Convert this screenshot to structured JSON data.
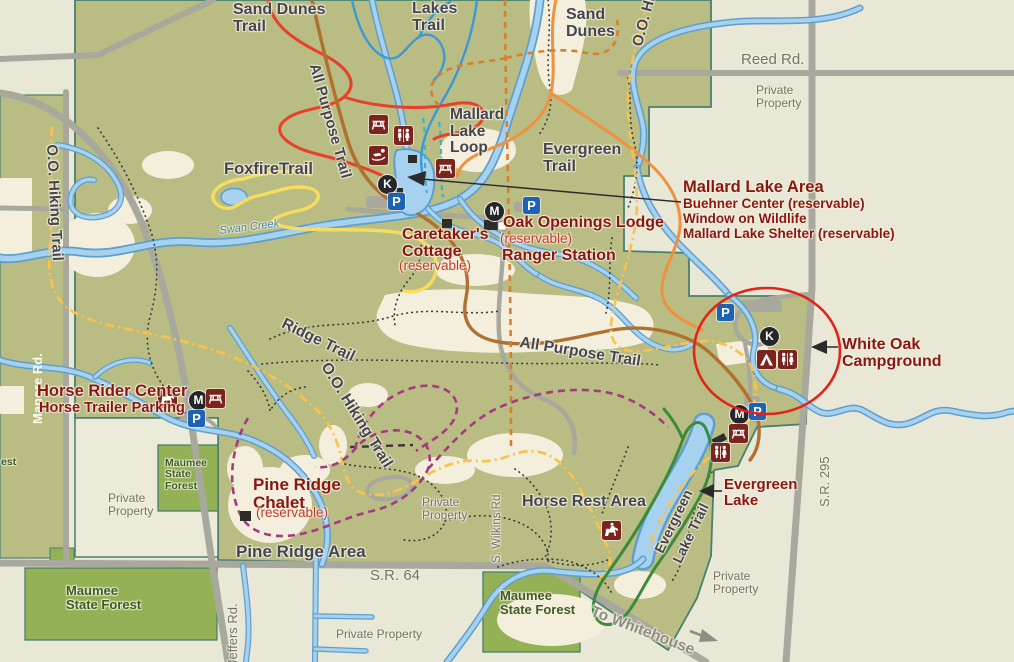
{
  "map_title": "Oak Openings park trail map",
  "colors": {
    "park_green": "#b9bc83",
    "forest_green": "#94b156",
    "background_cream": "#e9e7d6",
    "open_sand": "#f3efdc",
    "water_fill": "#a6d2ef",
    "water_edge": "#5f9fce",
    "road_gray": "#a9a89d",
    "boundary_teal": "#47806f",
    "label_dark": "#45454e",
    "label_red": "#8a170f",
    "reservable_red": "#c23b2a",
    "road_label_gray": "#73736b",
    "forest_label_green": "#3d5b23",
    "icon_maroon": "#7b231c",
    "parking_blue": "#1d62b5",
    "annotation_red": "#e2231a",
    "trail_red": "#e8402b",
    "trail_orange": "#f09140",
    "trail_brown": "#b0702f",
    "trail_yellow": "#f6dc60",
    "trail_yellow_dashdot": "#f9c24e",
    "trail_orange_dashed": "#d87f2f",
    "trail_purple": "#a43a80",
    "trail_green": "#3c8a3e",
    "trail_blue": "#3a9ad6",
    "trail_teal_dashed": "#35b8c4"
  },
  "trail_labels": {
    "sand_dunes_trail": "Sand Dunes\nTrail",
    "lakes_trail": "Lakes\nTrail",
    "sand_dunes": "Sand\nDunes",
    "oo_hiking_partial": "O.O. Hi",
    "all_purpose_north": "All Purpose Trail",
    "mallard_lake_loop": "Mallard\nLake\nLoop",
    "evergreen_trail": "Evergreen\nTrail",
    "foxfire_trail": "FoxfireTrail",
    "oo_hiking_west": "O.O. Hiking Trail",
    "ridge_trail": "Ridge Trail",
    "all_purpose_mid": "All Purpose Trail",
    "oo_hiking_mid": "O.O. Hiking Trail",
    "evergreen_lake_trail_line1": "Evergreen",
    "evergreen_lake_trail_line2": "Lake Trail"
  },
  "road_labels": {
    "reed_rd": "Reed Rd.",
    "manore_rd": "Manore Rd.",
    "sr_295": "S.R. 295",
    "sr_64": "S.R. 64",
    "jeffers_rd": "Jeffers Rd.",
    "s_wilkins_rd": "S. Wilkins Rd.",
    "to_whitehouse": "To Whitehouse"
  },
  "water_labels": {
    "swan_creek": "Swan Creek"
  },
  "poi": {
    "mallard_lake_area": {
      "title": "Mallard Lake Area",
      "line1": "Buehner Center (reservable)",
      "line2": "Window on Wildlife",
      "line3": "Mallard Lake Shelter (reservable)"
    },
    "caretakers_cottage": {
      "name": "Caretaker's\nCottage",
      "note": "(reservable)"
    },
    "oak_openings_lodge": {
      "name": "Oak Openings Lodge",
      "note": "(reservable)"
    },
    "ranger_station": "Ranger Station",
    "white_oak_campground": "White Oak Campground",
    "horse_rider_center": "Horse Rider Center",
    "horse_trailer_parking": "Horse Trailer Parking",
    "pine_ridge_chalet": {
      "name": "Pine Ridge\nChalet",
      "note": "(reservable)"
    },
    "pine_ridge_area": "Pine Ridge Area",
    "horse_rest_area": "Horse Rest Area",
    "evergreen_lake": "Evergreen\nLake"
  },
  "area_labels": {
    "private_property": "Private\nProperty",
    "private_property_single": "Private Property",
    "maumee_state_forest": "Maumee\nState Forest",
    "maumee_state_forest_small": "Maumee\nState\nForest",
    "est_fragment": "est"
  },
  "markers": {
    "parking": "P",
    "k": "K",
    "m": "M"
  }
}
